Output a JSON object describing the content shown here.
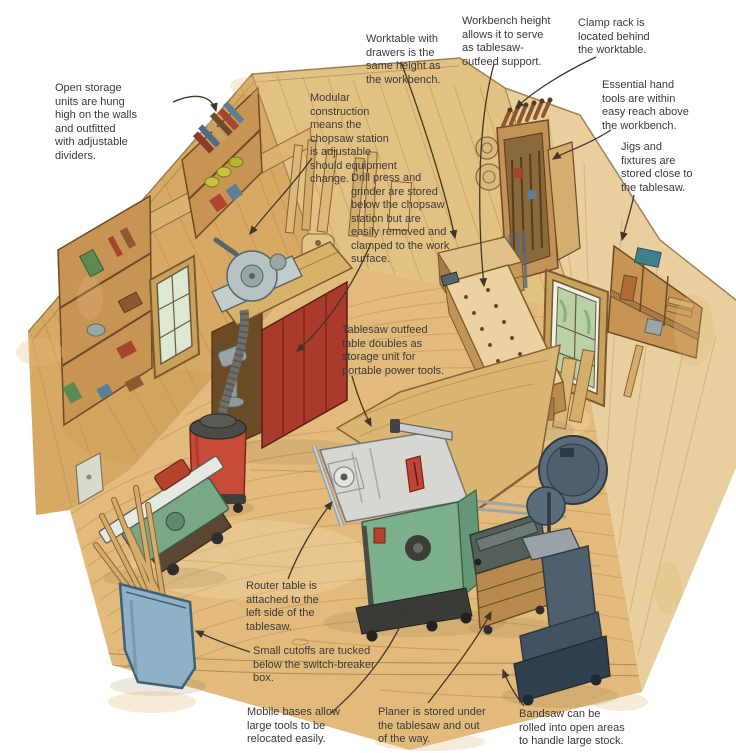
{
  "figure": {
    "type": "illustrated-shop-layout",
    "description": "Hand-drawn watercolor cutaway illustration of a small woodworking shop with annotated callouts"
  },
  "colors": {
    "background": "#ffffff",
    "floor_wood": "#e2bb7c",
    "wall_left": "#d8a964",
    "wall_back": "#e3c183",
    "wall_right": "#e9cf9d",
    "wood_outline": "#7a5a2e",
    "cabinet_red": "#aa3a2c",
    "vacuum_red": "#c84a38",
    "jointer_green": "#79a886",
    "tablesaw_base_green": "#7cb08d",
    "tablesaw_top_gray": "#d6d6d2",
    "insert_red": "#bf4538",
    "bin_blue": "#8fb0c6",
    "bandsaw_slate": "#5a6b7a",
    "planer_slate": "#55605c",
    "bench_maple": "#ecd2a0",
    "window_green": "#b9d0a8",
    "annotation_text": "#3a3a3a",
    "leader_line": "#42362a"
  },
  "annotations": [
    {
      "id": "open-storage",
      "text": "Open storage\nunits are hung\nhigh on the walls\nand outfitted\nwith adjustable\ndividers."
    },
    {
      "id": "modular",
      "text": "Modular\nconstruction\nmeans the\nchopsaw station\nis adjustable\nshould equipment\nchange."
    },
    {
      "id": "worktable",
      "text": "Worktable with\ndrawers is the\nsame height as\nthe workbench."
    },
    {
      "id": "workbench-height",
      "text": "Workbench height\nallows it to serve\nas tablesaw-\noutfeed support."
    },
    {
      "id": "clamp-rack",
      "text": "Clamp rack is\nlocated behind\nthe worktable."
    },
    {
      "id": "essential-hand",
      "text": "Essential hand\ntools are within\neasy reach above\nthe workbench."
    },
    {
      "id": "jigs-fixtures",
      "text": "Jigs and\nfixtures are\nstored close to\nthe tablesaw."
    },
    {
      "id": "drill-press",
      "text": "Drill press and\ngrinder are stored\nbelow the chopsaw\nstation but are\neasily removed and\nclamped to the work\nsurface."
    },
    {
      "id": "tablesaw-outfeed",
      "text": "Tablesaw outfeed\ntable doubles as\nstorage unit for\nportable power tools."
    },
    {
      "id": "router-table",
      "text": "Router table is\nattached to the\nleft side of the\ntablesaw."
    },
    {
      "id": "small-cutoffs",
      "text": "Small cutoffs are tucked\nbelow the switch-breaker\nbox."
    },
    {
      "id": "mobile-bases",
      "text": "Mobile bases allow\nlarge tools to be\nrelocated easily."
    },
    {
      "id": "planer",
      "text": "Planer is stored under\nthe tablesaw and out\nof the way."
    },
    {
      "id": "bandsaw",
      "text": "Bandsaw can be\nrolled into open areas\nto handle large stock."
    }
  ]
}
